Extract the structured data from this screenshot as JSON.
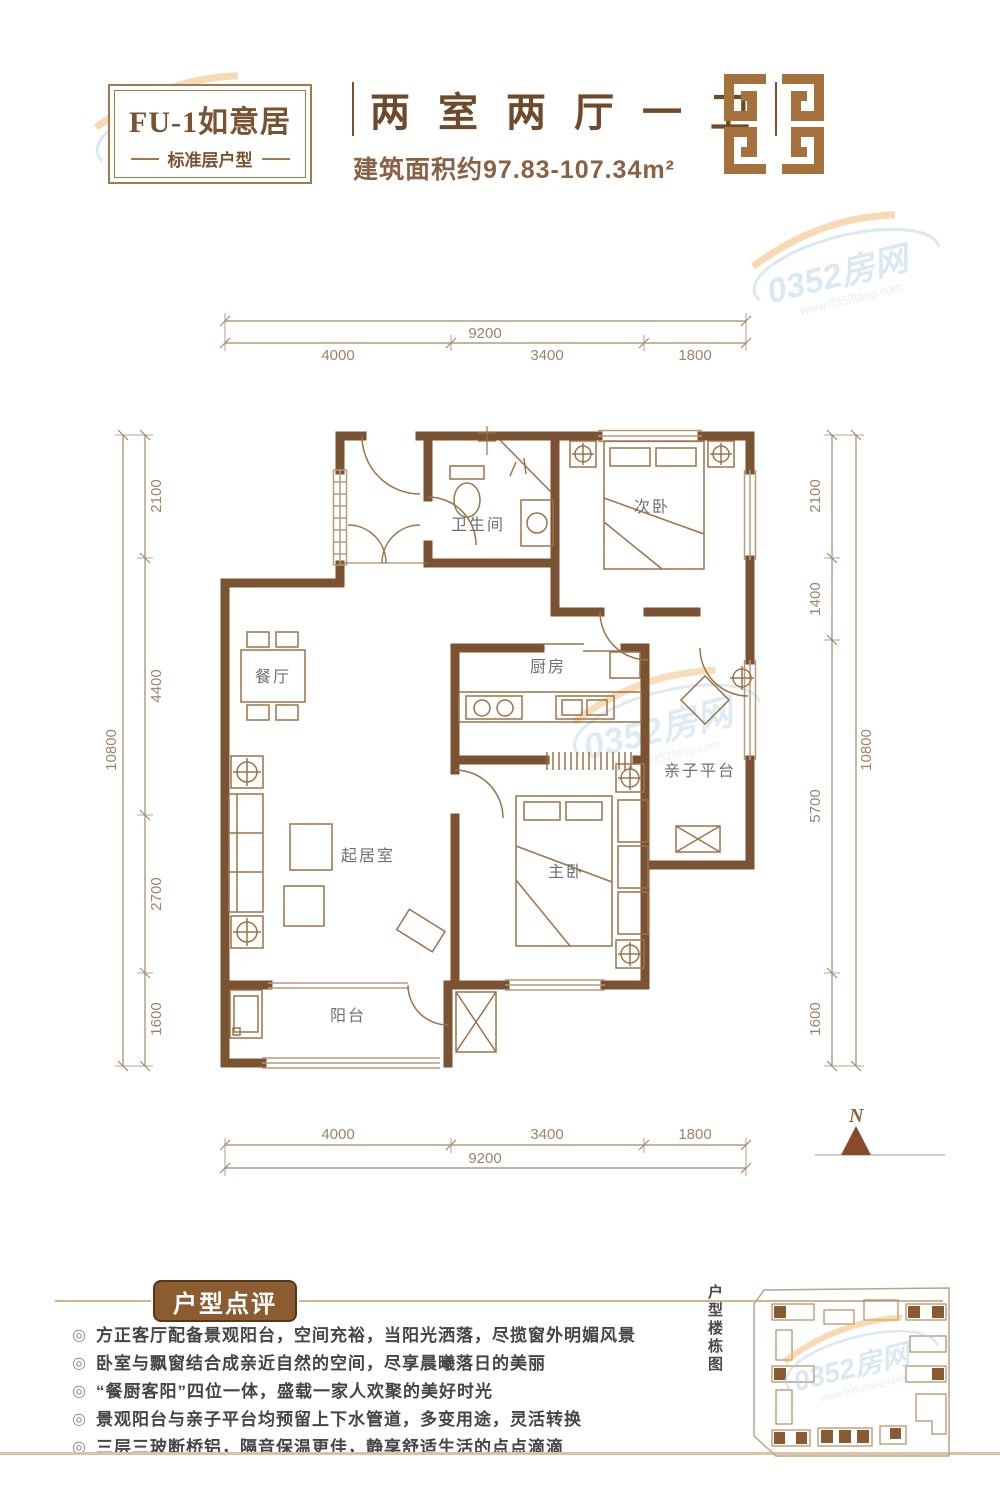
{
  "header": {
    "plan_code": "FU-1如意居",
    "plan_type": "标准层户型",
    "title": "两 室 两 厅 一 卫",
    "area": "建筑面积约97.83-107.34m²"
  },
  "plan": {
    "rooms": {
      "bathroom": "卫生间",
      "second_bedroom": "次卧",
      "kitchen": "厨房",
      "platform": "亲子平台",
      "dining": "餐厅",
      "living": "起居室",
      "master_bedroom": "主卧",
      "balcony": "阳台"
    },
    "dims": {
      "top_total": "9200",
      "top_segments": [
        "4000",
        "3400",
        "1800"
      ],
      "bottom_segments": [
        "4000",
        "3400",
        "1800"
      ],
      "bottom_total": "9200",
      "left_total": "10800",
      "left_segments": [
        "2100",
        "4400",
        "2700",
        "1600"
      ],
      "right_segments": [
        "2100",
        "1400",
        "5700",
        "1600"
      ],
      "right_total": "10800"
    },
    "compass": "N"
  },
  "comments": {
    "heading": "户型点评",
    "bullet_icon": "◎",
    "items": [
      "方正客厅配备景观阳台，空间充裕，当阳光洒落，尽揽窗外明媚风景",
      "卧室与飘窗结合成亲近自然的空间，尽享晨曦落日的美丽",
      "“餐厨客阳”四位一体，盛载一家人欢聚的美好时光",
      "景观阳台与亲子平台均预留上下水管道，多变用途，灵活转换",
      "三层三玻断桥铝，隔音保温更佳，静享舒适生活的点点滴滴"
    ]
  },
  "sitemap_label": "户型楼栋图",
  "watermark": {
    "text": "0352房网",
    "url": "www.0352fang.com"
  },
  "colors": {
    "wall_brown": "#7b5232",
    "accent_brown": "#8a5c30",
    "logo_brown": "#a5713c",
    "dim_line": "#a08868",
    "room_text": "#6f6f6f",
    "watermark_blue": "#b5d4e8",
    "watermark_orange": "#f0b469"
  }
}
